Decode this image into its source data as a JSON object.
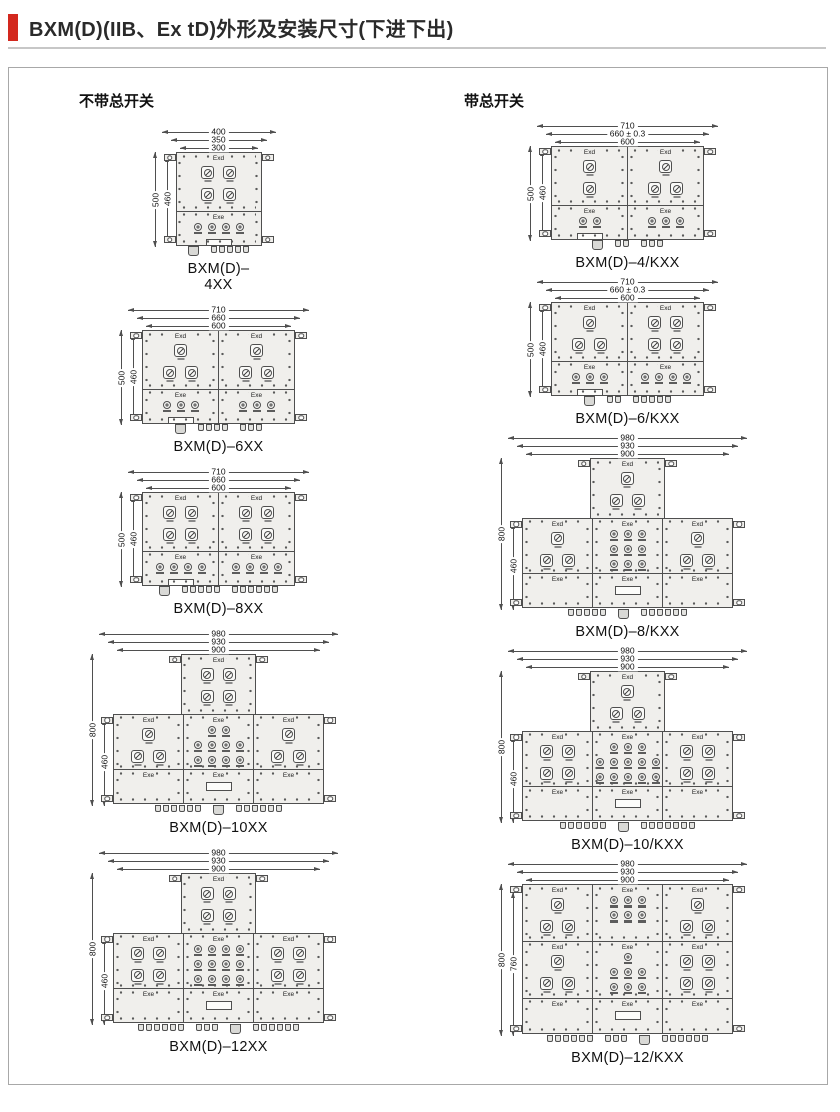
{
  "header": {
    "title": "BXM(D)(IIB、Ex tD)外形及安装尺寸(下进下出)",
    "accent_color": "#d3281e"
  },
  "drawing_style": {
    "line_color": "#4f4f4f",
    "fill_color": "#f0efec"
  },
  "columns": [
    {
      "heading": "不带总开关",
      "figures": [
        {
          "caption": "BXM(D)–4XX",
          "dims_top": [
            "400",
            "350",
            "300"
          ],
          "dims_left": [
            "500",
            "460"
          ],
          "layout": "stack",
          "rows": [
            [
              {
                "label": "Exd",
                "squares": [
                  2,
                  2
                ]
              }
            ],
            [
              {
                "label": "Exe",
                "circles": [
                  4
                ],
                "plate": true
              }
            ]
          ],
          "glands": [
            {
              "count": 1,
              "big": true
            },
            {
              "count": 5
            }
          ]
        },
        {
          "caption": "BXM(D)–6XX",
          "dims_top": [
            "710",
            "660",
            "600"
          ],
          "dims_left": [
            "500",
            "460"
          ],
          "layout": "stack",
          "rows": [
            [
              {
                "label": "Exd",
                "squares": [
                  1,
                  2
                ]
              },
              {
                "label": "Exd",
                "squares": [
                  1,
                  2
                ]
              }
            ],
            [
              {
                "label": "Exe",
                "circles": [
                  3
                ],
                "plate": true
              },
              {
                "label": "Exe",
                "circles": [
                  3
                ]
              }
            ]
          ],
          "glands": [
            {
              "count": 1,
              "big": true
            },
            {
              "count": 4
            },
            {
              "count": 3
            }
          ]
        },
        {
          "caption": "BXM(D)–8XX",
          "dims_top": [
            "710",
            "660",
            "600"
          ],
          "dims_left": [
            "500",
            "460"
          ],
          "layout": "stack",
          "rows": [
            [
              {
                "label": "Exd",
                "squares": [
                  2,
                  2
                ]
              },
              {
                "label": "Exd",
                "squares": [
                  2,
                  2
                ]
              }
            ],
            [
              {
                "label": "Exe",
                "circles": [
                  4
                ],
                "plate": true
              },
              {
                "label": "Exe",
                "circles": [
                  4
                ]
              }
            ]
          ],
          "glands": [
            {
              "count": 1,
              "big": true
            },
            {
              "count": 5
            },
            {
              "count": 6
            }
          ]
        },
        {
          "caption": "BXM(D)–10XX",
          "dims_top": [
            "980",
            "930",
            "900"
          ],
          "dims_left": [
            "800",
            "460"
          ],
          "layout": "tee",
          "top": {
            "label": "Exd",
            "squares": [
              2,
              2
            ]
          },
          "rows": [
            [
              {
                "label": "Exd",
                "squares": [
                  1,
                  2
                ]
              },
              {
                "label": "Exe",
                "circles": [
                  2,
                  4,
                  4
                ]
              },
              {
                "label": "Exd",
                "squares": [
                  1,
                  2
                ]
              }
            ],
            [
              {
                "label": "Exe"
              },
              {
                "label": "Exe",
                "plate": true
              },
              {
                "label": "Exe"
              }
            ]
          ],
          "glands": [
            {
              "count": 6
            },
            {
              "count": 1,
              "big": true
            },
            {
              "count": 6
            }
          ]
        },
        {
          "caption": "BXM(D)–12XX",
          "dims_top": [
            "980",
            "930",
            "900"
          ],
          "dims_left": [
            "800",
            "460"
          ],
          "layout": "tee",
          "top": {
            "label": "Exd",
            "squares": [
              2,
              2
            ]
          },
          "rows": [
            [
              {
                "label": "Exd",
                "squares": [
                  2,
                  2
                ]
              },
              {
                "label": "Exe",
                "circles": [
                  4,
                  4,
                  4,
                  4
                ]
              },
              {
                "label": "Exd",
                "squares": [
                  2,
                  2
                ]
              }
            ],
            [
              {
                "label": "Exe"
              },
              {
                "label": "Exe",
                "plate": true
              },
              {
                "label": "Exe"
              }
            ]
          ],
          "glands": [
            {
              "count": 6
            },
            {
              "count": 3
            },
            {
              "count": 1,
              "big": true
            },
            {
              "count": 6
            }
          ]
        }
      ]
    },
    {
      "heading": "带总开关",
      "figures": [
        {
          "caption": "BXM(D)–4/KXX",
          "dims_top": [
            "710",
            "660 ± 0.3",
            "600"
          ],
          "dims_left": [
            "500",
            "460"
          ],
          "layout": "stack",
          "rows": [
            [
              {
                "label": "Exd",
                "squares": [
                  1,
                  1
                ]
              },
              {
                "label": "Exd",
                "squares": [
                  1,
                  2
                ]
              }
            ],
            [
              {
                "label": "Exe",
                "circles": [
                  2
                ],
                "plate": true
              },
              {
                "label": "Exe",
                "circles": [
                  3
                ]
              }
            ]
          ],
          "glands": [
            {
              "count": 1,
              "big": true
            },
            {
              "count": 2
            },
            {
              "count": 3
            }
          ]
        },
        {
          "caption": "BXM(D)–6/KXX",
          "dims_top": [
            "710",
            "660 ± 0.3",
            "600"
          ],
          "dims_left": [
            "500",
            "460"
          ],
          "layout": "stack",
          "rows": [
            [
              {
                "label": "Exd",
                "squares": [
                  1,
                  2
                ]
              },
              {
                "label": "Exd",
                "squares": [
                  2,
                  2
                ]
              }
            ],
            [
              {
                "label": "Exe",
                "circles": [
                  3
                ],
                "plate": true
              },
              {
                "label": "Exe",
                "circles": [
                  4
                ]
              }
            ]
          ],
          "glands": [
            {
              "count": 1,
              "big": true
            },
            {
              "count": 2
            },
            {
              "count": 5
            }
          ]
        },
        {
          "caption": "BXM(D)–8/KXX",
          "dims_top": [
            "980",
            "930",
            "900"
          ],
          "dims_left": [
            "800",
            "460"
          ],
          "layout": "tee",
          "top": {
            "label": "Exd",
            "squares": [
              1,
              2
            ]
          },
          "rows": [
            [
              {
                "label": "Exd",
                "squares": [
                  1,
                  2
                ]
              },
              {
                "label": "Exe",
                "circles": [
                  3,
                  3,
                  3
                ]
              },
              {
                "label": "Exd",
                "squares": [
                  1,
                  2
                ]
              }
            ],
            [
              {
                "label": "Exe"
              },
              {
                "label": "Exe",
                "plate": true
              },
              {
                "label": "Exe"
              }
            ]
          ],
          "glands": [
            {
              "count": 5
            },
            {
              "count": 1,
              "big": true
            },
            {
              "count": 6
            }
          ]
        },
        {
          "caption": "BXM(D)–10/KXX",
          "dims_top": [
            "980",
            "930",
            "900"
          ],
          "dims_left": [
            "800",
            "460"
          ],
          "layout": "tee",
          "top": {
            "label": "Exd",
            "squares": [
              1,
              2
            ]
          },
          "rows": [
            [
              {
                "label": "Exd",
                "squares": [
                  2,
                  2
                ]
              },
              {
                "label": "Exe",
                "circles": [
                  3,
                  5,
                  5
                ]
              },
              {
                "label": "Exd",
                "squares": [
                  2,
                  2
                ]
              }
            ],
            [
              {
                "label": "Exe"
              },
              {
                "label": "Exe",
                "plate": true
              },
              {
                "label": "Exe"
              }
            ]
          ],
          "glands": [
            {
              "count": 6
            },
            {
              "count": 1,
              "big": true
            },
            {
              "count": 7
            }
          ]
        },
        {
          "caption": "BXM(D)–12/KXX",
          "dims_top": [
            "980",
            "930",
            "900"
          ],
          "dims_left": [
            "800",
            "760"
          ],
          "layout": "grid",
          "rows": [
            [
              {
                "label": "Exd",
                "squares": [
                  1,
                  2
                ]
              },
              {
                "label": "Exe",
                "circles": [
                  3,
                  3
                ]
              },
              {
                "label": "Exd",
                "squares": [
                  1,
                  2
                ]
              }
            ],
            [
              {
                "label": "Exd",
                "squares": [
                  1,
                  2
                ]
              },
              {
                "label": "Exe",
                "circles": [
                  1,
                  3,
                  3
                ]
              },
              {
                "label": "Exd",
                "squares": [
                  2,
                  2
                ]
              }
            ],
            [
              {
                "label": "Exe"
              },
              {
                "label": "Exe",
                "plate": true
              },
              {
                "label": "Exe"
              }
            ]
          ],
          "glands": [
            {
              "count": 6
            },
            {
              "count": 3
            },
            {
              "count": 1,
              "big": true
            },
            {
              "count": 6
            }
          ]
        }
      ]
    }
  ]
}
